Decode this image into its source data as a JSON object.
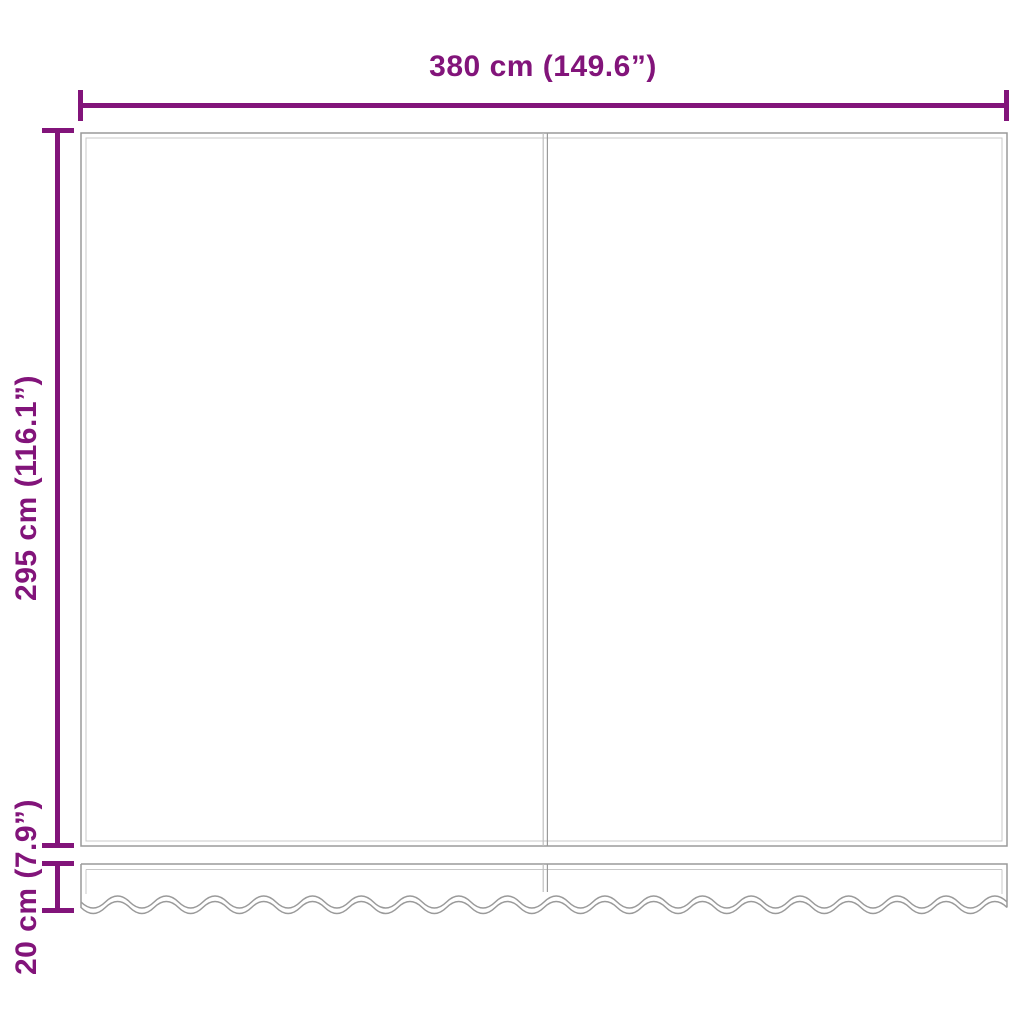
{
  "diagram": {
    "labels": {
      "width": "380 cm (149.6”)",
      "height": "295 cm (116.1”)",
      "valance_height": "20 cm (7.9”)"
    },
    "colors": {
      "dimension_lines": "#82147A",
      "fabric_outline": "#9A9A9A",
      "fabric_seam": "#C8C8C8",
      "background": "#FFFFFF"
    }
  }
}
